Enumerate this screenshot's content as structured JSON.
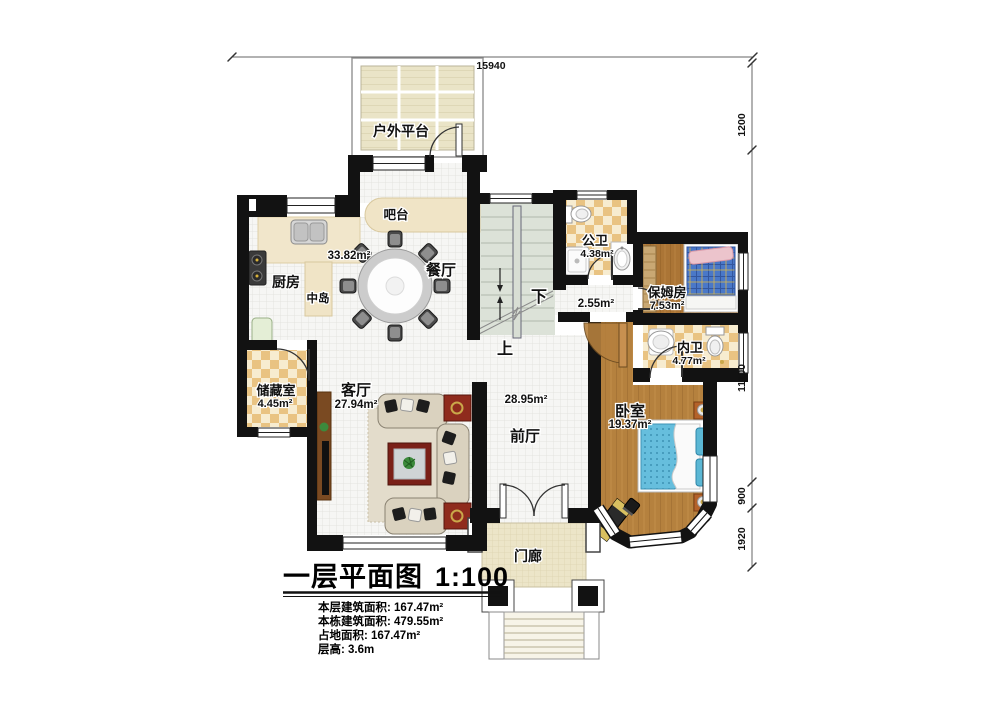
{
  "plan": {
    "rooms": {
      "platform": {
        "label": "户外平台"
      },
      "bar": {
        "label": "吧台"
      },
      "kitchen": {
        "label": "厨房"
      },
      "island": {
        "label": "中岛"
      },
      "open_area": {
        "area": "33.82m²"
      },
      "dining": {
        "label": "餐厅"
      },
      "public_bath": {
        "label": "公卫",
        "area": "4.38m²"
      },
      "hall_nook": {
        "area": "2.55m²"
      },
      "nanny": {
        "label": "保姆房",
        "area": "7.53m²"
      },
      "inner_bath": {
        "label": "内卫",
        "area": "4.77m²"
      },
      "storage": {
        "label": "储藏室",
        "area": "4.45m²"
      },
      "living": {
        "label": "客厅",
        "area": "27.94m²"
      },
      "front_hall": {
        "label": "前厅",
        "area": "28.95m²"
      },
      "bedroom": {
        "label": "卧室",
        "area": "19.37m²"
      },
      "porch": {
        "label": "门廊"
      }
    },
    "stairs": {
      "down": "下",
      "up": "上"
    },
    "dims": {
      "top": "15940",
      "right_1": "1200",
      "right_2": "11100",
      "right_3": "900",
      "right_4": "1920"
    },
    "legend": {
      "title": "一层平面图",
      "scale": "1:100",
      "line1": "本层建筑面积: 167.47m²",
      "line2": "本栋建筑面积: 479.55m²",
      "line3": "占地面积: 167.47m²",
      "line4": "层高: 3.6m"
    },
    "colors": {
      "wall": "#121212",
      "tile": "#f6f6f4",
      "wood": "#ab7536",
      "checker": "#e9c382",
      "stair": "#dce2d8",
      "deck": "#eae4c7"
    }
  }
}
